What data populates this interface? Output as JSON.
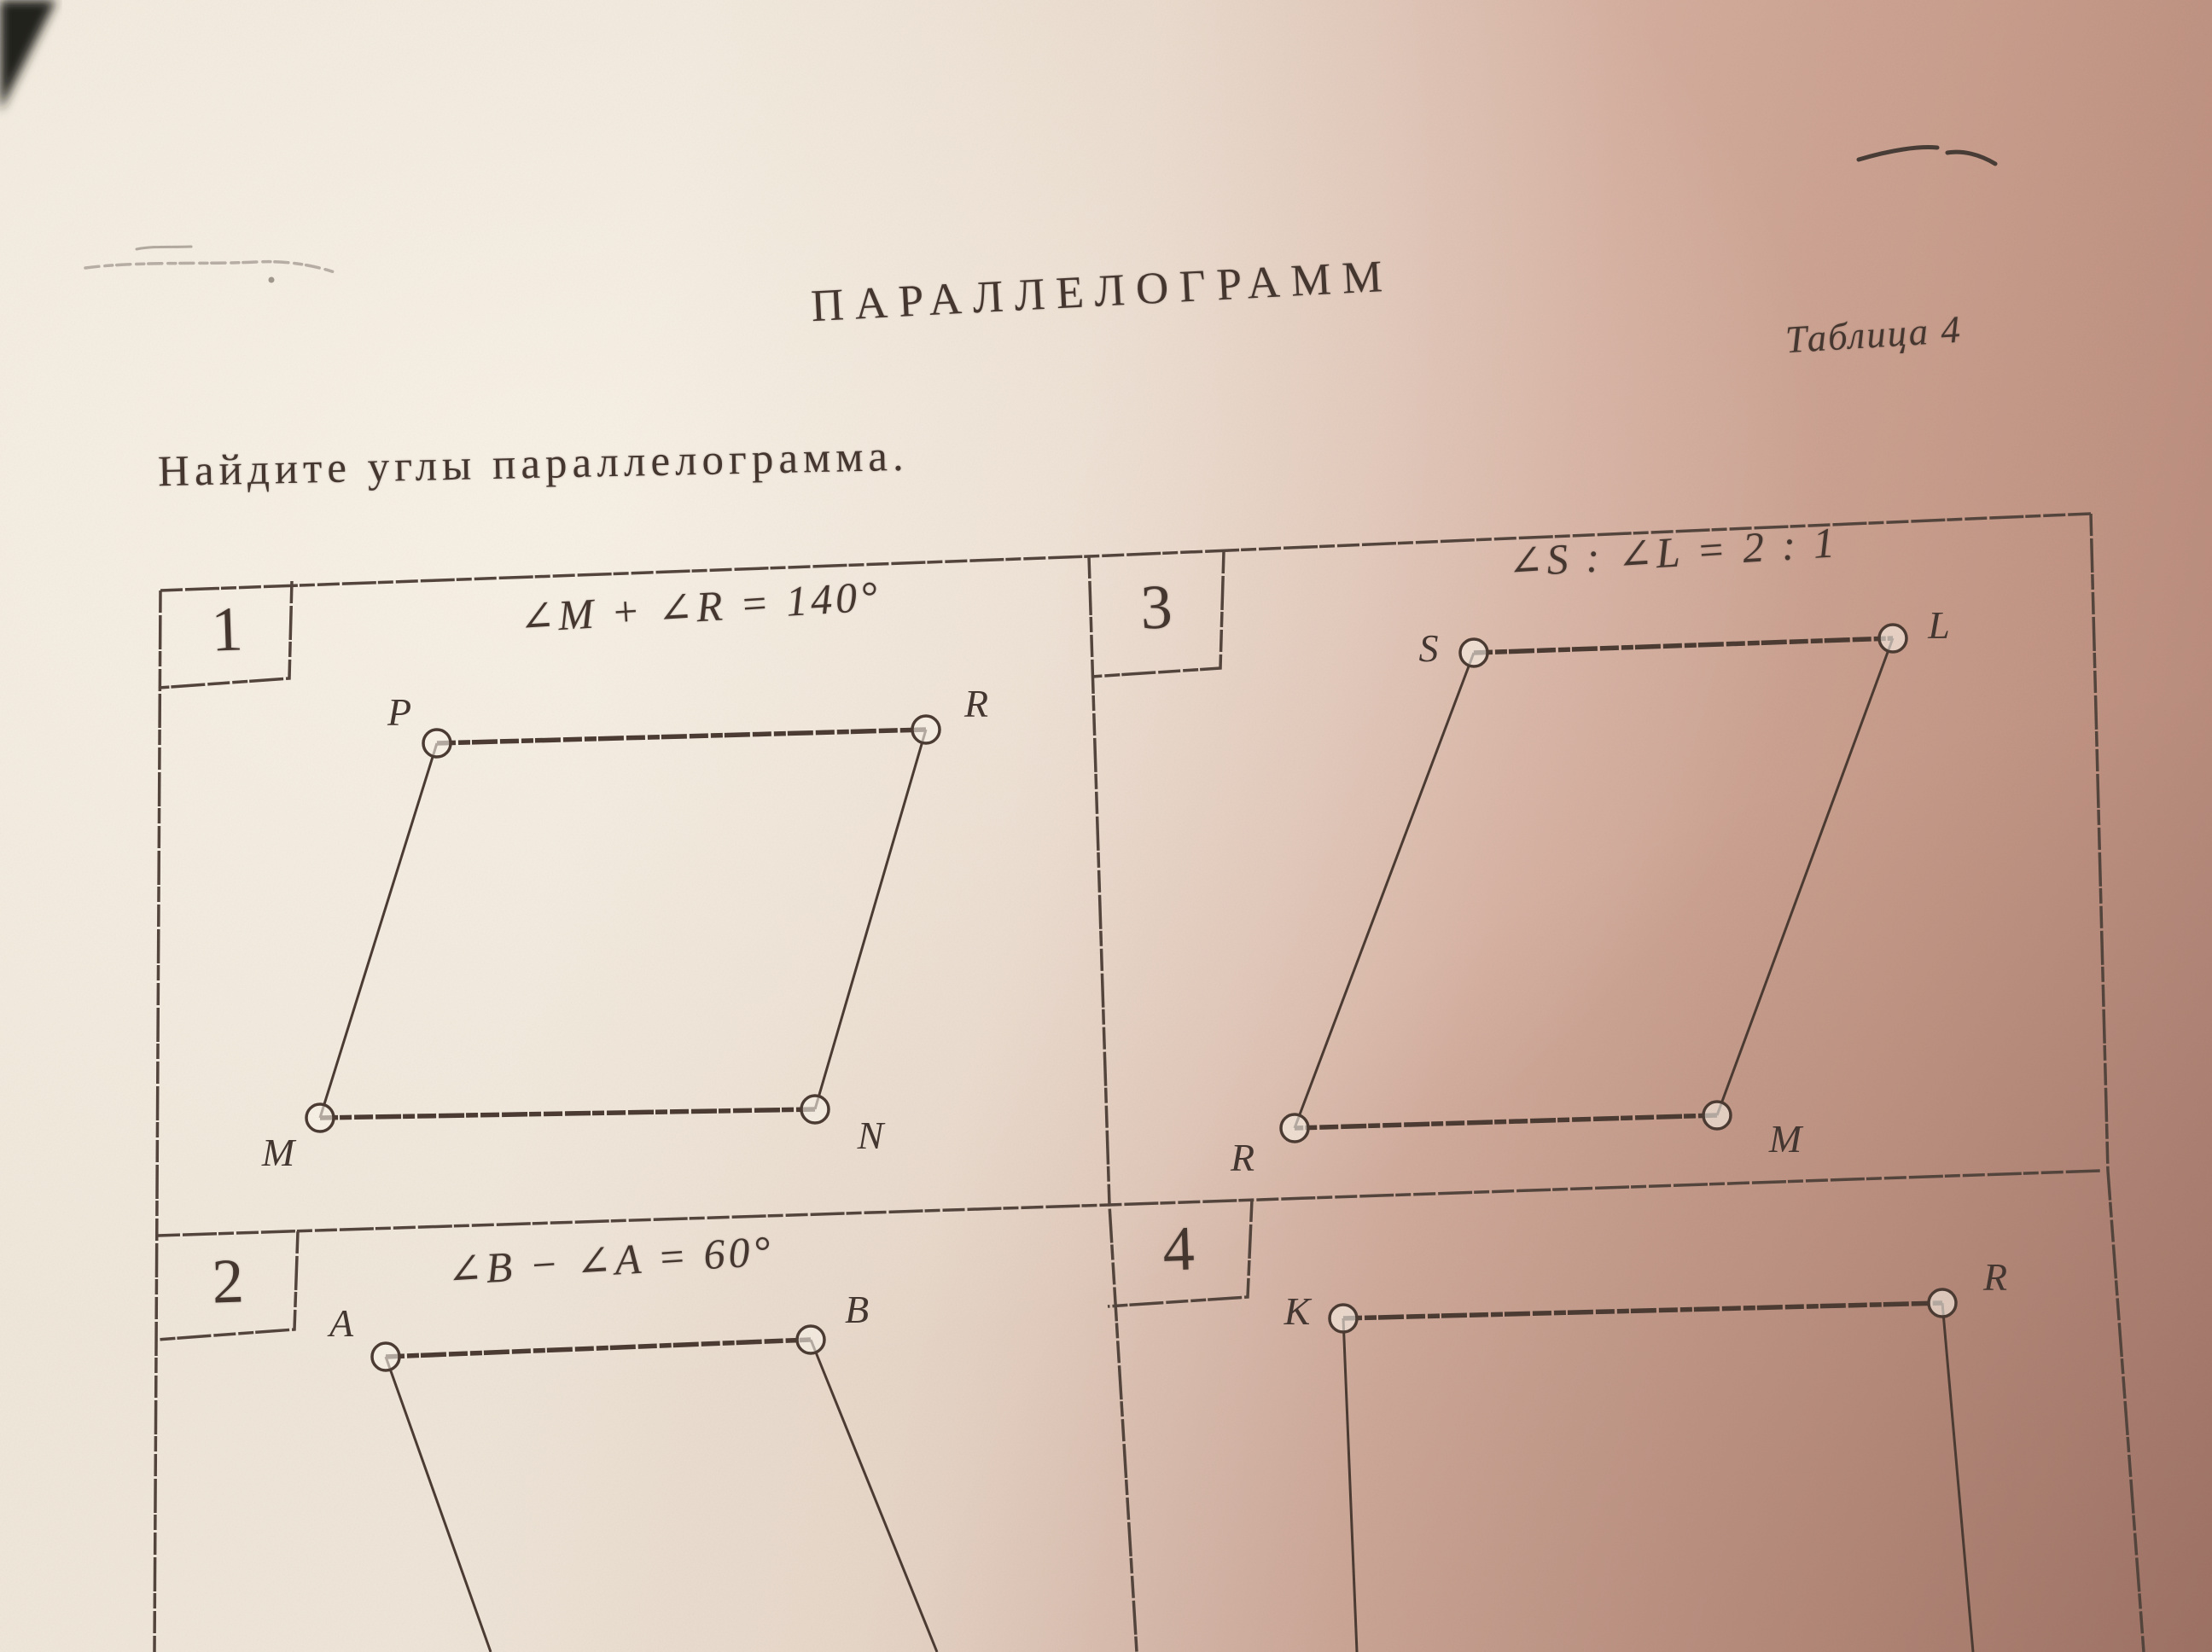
{
  "page": {
    "heading": "ПАРАЛЛЕЛОГРАММ",
    "table_caption": "Таблица 4",
    "task": "Найдите углы параллелограмма."
  },
  "problems": [
    {
      "number": "1",
      "condition": "∠M + ∠R = 140°",
      "vertices": {
        "top_left": "P",
        "top_right": "R",
        "bottom_right": "N",
        "bottom_left": "M"
      }
    },
    {
      "number": "2",
      "condition": "∠B − ∠A = 60°",
      "vertices": {
        "top_left": "A",
        "top_right": "B"
      }
    },
    {
      "number": "3",
      "condition": "∠S : ∠L = 2 : 1",
      "vertices": {
        "top_left": "S",
        "top_right": "L",
        "bottom_right": "M",
        "bottom_left": "R"
      }
    },
    {
      "number": "4",
      "vertices": {
        "top_left": "K",
        "top_right": "R"
      }
    }
  ],
  "colors": {
    "paper_highlight": "#f0e8db",
    "paper_shadow": "#b28577",
    "ink": "#453730",
    "line": "#4b3b32"
  }
}
